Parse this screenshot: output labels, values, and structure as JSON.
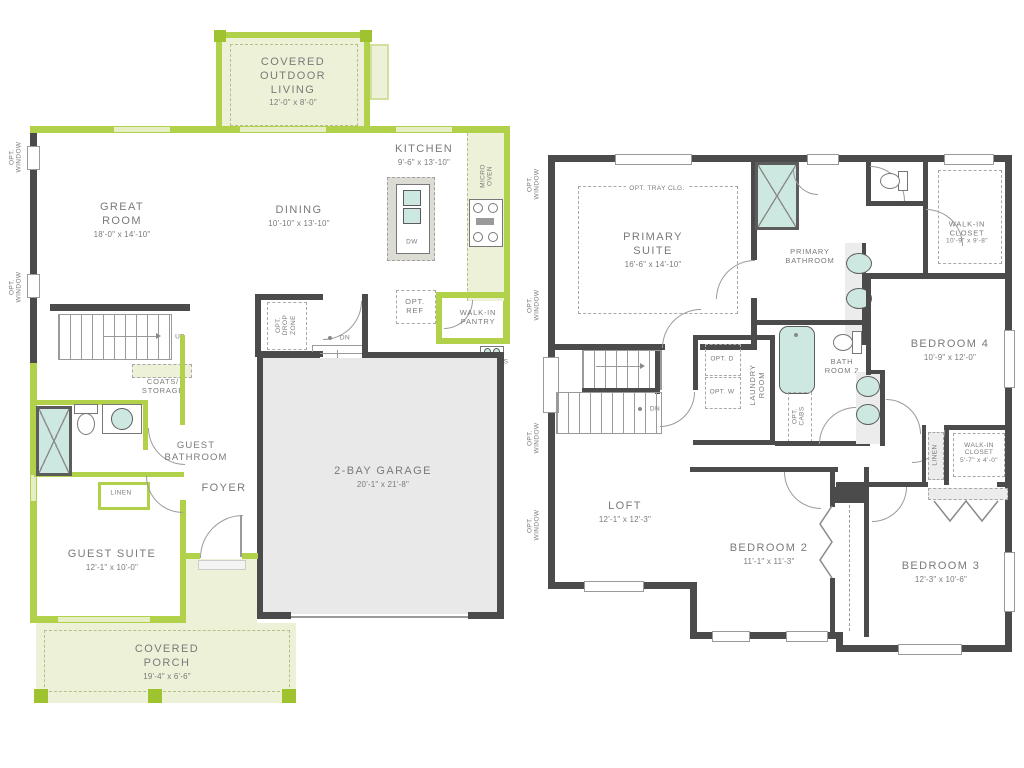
{
  "colors": {
    "lime": "#b2d14a",
    "lime_dark": "#9fc32f",
    "pale": "#edf1d8",
    "dark": "#4b4b4b",
    "fill_gray": "#e9e9e9",
    "teal": "#cde8e1",
    "text": "#7a7a7a",
    "line": "#9a9a9a"
  },
  "floor1": {
    "outdoor_living": {
      "name": "COVERED OUTDOOR LIVING",
      "dims": "12'-0\" x 8'-0\""
    },
    "great_room": {
      "name": "GREAT ROOM",
      "dims": "18'-0\" x 14'-10\""
    },
    "dining": {
      "name": "DINING",
      "dims": "10'-10\" x 13'-10\""
    },
    "kitchen": {
      "name": "KITCHEN",
      "dims": "9'-6\" x 13'-10\""
    },
    "micro_oven": "MICRO OVEN",
    "dw": "DW",
    "opt_drop_zone": "OPT. DROP ZONE",
    "opt_ref": "OPT. REF",
    "walk_in_pantry": "WALK-IN PANTRY",
    "tankless_wh": "TANKLESS WH",
    "up": "UP",
    "dn": "DN",
    "coats_storage": "COATS/ STORAGE",
    "guest_bathroom": "GUEST BATHROOM",
    "linen": "LINEN",
    "foyer": "FOYER",
    "guest_suite": {
      "name": "GUEST SUITE",
      "dims": "12'-1\" x 10'-0\""
    },
    "garage": {
      "name": "2-BAY GARAGE",
      "dims": "20'-1\" x 21'-8\""
    },
    "covered_porch": {
      "name": "COVERED PORCH",
      "dims": "19'-4\" x 6'-6\""
    },
    "opt_window": "OPT. WINDOW"
  },
  "floor2": {
    "opt_tray": "OPT. TRAY CLG.",
    "primary_suite": {
      "name": "PRIMARY SUITE",
      "dims": "16'-6\" x 14'-10\""
    },
    "primary_bathroom": "PRIMARY BATHROOM",
    "walk_in_closet_1": {
      "name": "WALK-IN CLOSET",
      "dims": "10'-9\" x 9'-8\""
    },
    "bath_room_2": "BATH ROOM 2",
    "laundry_room": "LAUNDRY ROOM",
    "opt_d": "OPT. D",
    "opt_w": "OPT. W",
    "opt_cabs": "OPT. CABS",
    "bedroom_4": {
      "name": "BEDROOM 4",
      "dims": "10'-9\" x 12'-0\""
    },
    "walk_in_closet_2": {
      "name": "WALK-IN CLOSET",
      "dims": "5'-7\" x 4'-0\""
    },
    "linen": "LINEN",
    "loft": {
      "name": "LOFT",
      "dims": "12'-1\" x 12'-3\""
    },
    "bedroom_2": {
      "name": "BEDROOM 2",
      "dims": "11'-1\" x 11'-3\""
    },
    "bedroom_3": {
      "name": "BEDROOM 3",
      "dims": "12'-3\" x 10'-6\""
    },
    "dn": "DN",
    "opt_window": "OPT. WINDOW"
  }
}
